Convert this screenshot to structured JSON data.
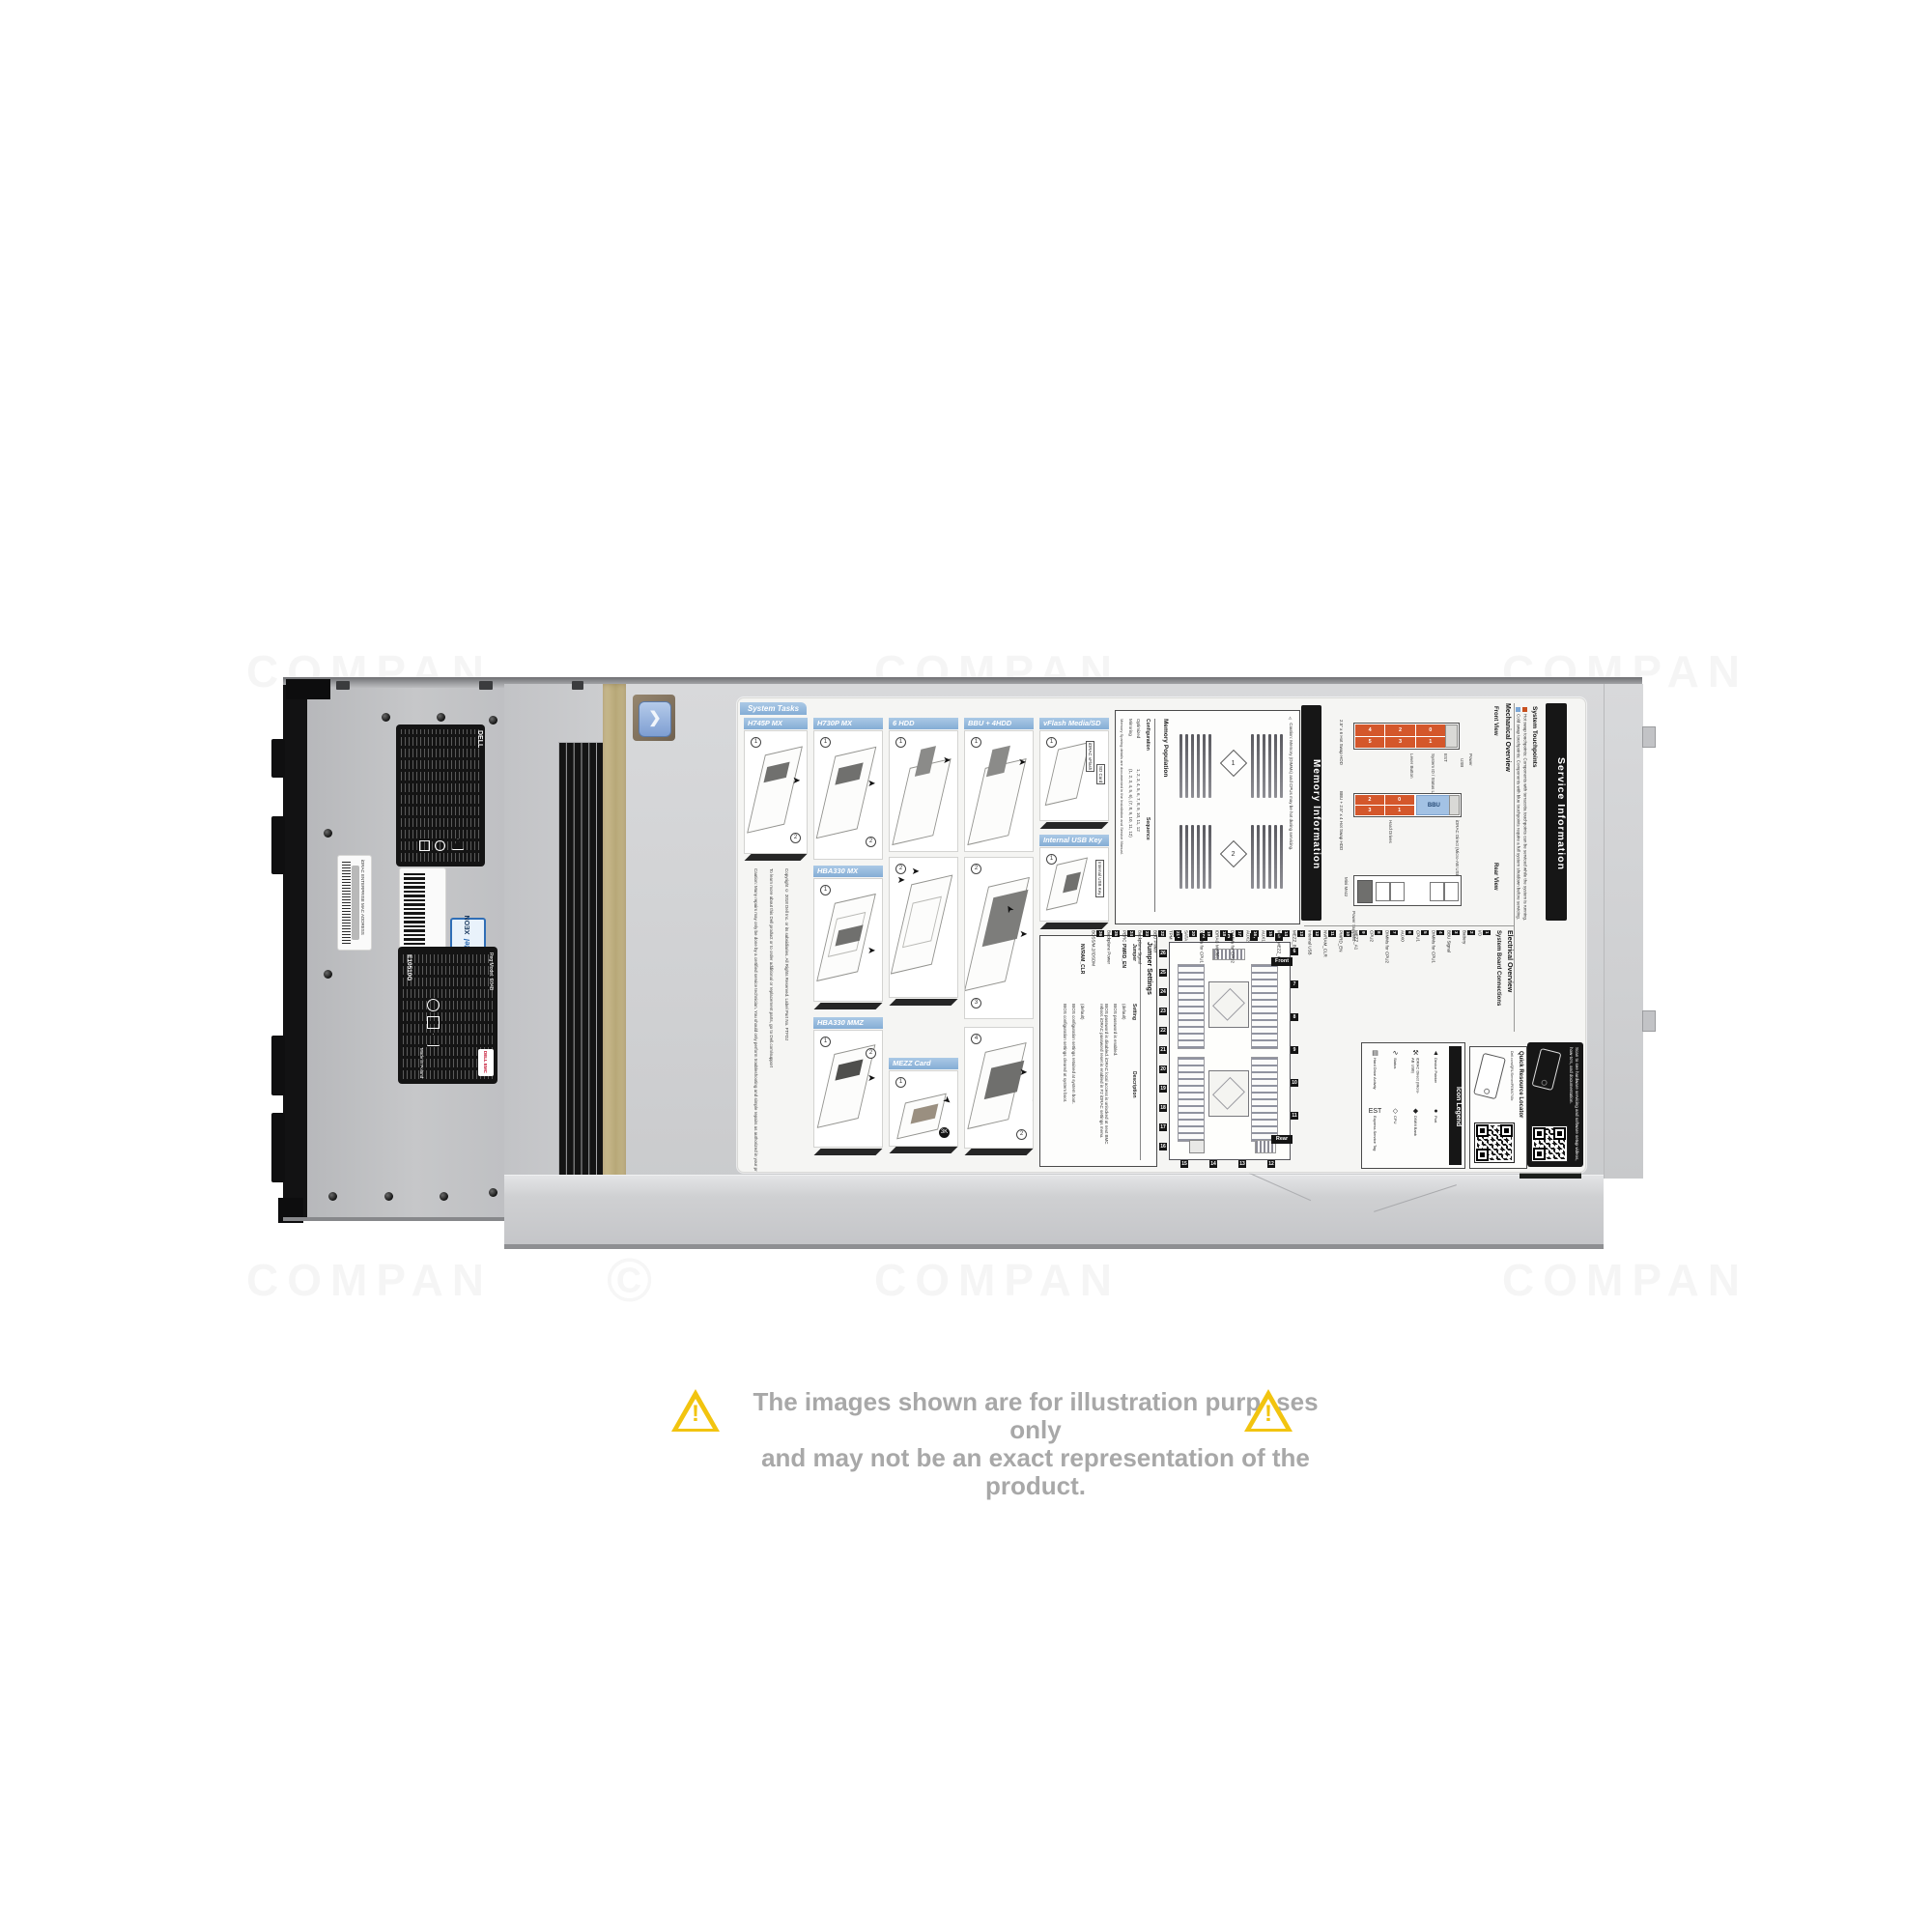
{
  "disclaimer": {
    "line1": "The images shown are for illustration purposes only",
    "line2": "and may not be an exact representation of the product."
  },
  "watermark": {
    "text": "COMPAN",
    "symbol": "©"
  },
  "chassis_labels": {
    "brand": "DELL",
    "service_tag": "253RQX2",
    "idrac_mac": "iDRAC ENTERPRISE MAC ADDRESS",
    "intel_line1": "intel",
    "intel_line2": "XEON",
    "reg_number": "E10510G",
    "reg_model": "Reg Model: E04B",
    "made_in": "Made in Poland",
    "dell_emc": "DELL EMC"
  },
  "service_label": {
    "system_tasks": {
      "tab": "System Tasks",
      "panels": [
        {
          "label": "H745P MX"
        },
        {
          "label": "H730P MX"
        },
        {
          "label": "HBA330 MX"
        },
        {
          "label": "HBA330 MMZ"
        },
        {
          "label": "6 HDD"
        },
        {
          "label": "MEZZ Card"
        },
        {
          "label": "BBU + 4HDD"
        },
        {
          "label": "vFlash Media/SD Card"
        },
        {
          "label": "Internal USB Key"
        }
      ],
      "vflash_callout1": "iDRAC vFlash",
      "vflash_callout2": "SD Card",
      "usb_callout": "Internal USB Key",
      "caution": "Caution: Many repairs may only be done by a certified service technician. You should only perform troubleshooting and simple repairs as authorized in your product documentation, or as directed by the online or telephone service and support team. Damage due to servicing that is not authorized by Dell is not covered by your warranty. Read and follow the safety instructions that came with this product.",
      "support": "To learn more about this Dell product or to order additional or replacement parts, go to Dell.com/support",
      "copyright": "Copyright © 2018 Dell Inc. or its subsidiaries. All Rights Reserved. Label Part No. FTFDJ"
    },
    "memory": {
      "header": "Memory Information",
      "caution": "⚠ Caution: Memory (DIMMs) and CPUs may be hot during servicing.",
      "title": "Memory Population",
      "col_config": "Configuration",
      "col_seq": "Sequence",
      "row1_name": "Optimized",
      "row1_seq": "1, 2, 3, 4, 5, 6, 7, 8, 9, 10, 11, 12",
      "row2_name": "Mirroring",
      "row2_seq": "(1, 2, 3, 4, 5, 6), (7, 8, 9, 10, 11, 12)",
      "note": "Memory Sparing details are documented in the Installation and Service Manual.",
      "cpu1": "1",
      "cpu2": "2"
    },
    "jumpers": {
      "title": "Jumper Settings",
      "col1": "Jumper",
      "col2": "Setting",
      "col3": "Description",
      "row1_name": "PWRD_EN",
      "row1_default": "(default)",
      "row1_desc_default": "BIOS password is enabled.",
      "row1_desc_alt": "BIOS password is disabled. iDRAC local access is unlocked at next BMC reboot. iDRAC password reset is enabled in F2 iDRAC settings menu.",
      "row2_name": "NVRAM_CLR",
      "row2_default": "(default)",
      "row2_desc_default": "BIOS configuration settings retained at system boot.",
      "row2_desc_alt": "BIOS configuration settings cleared at system boot."
    },
    "mechanical": {
      "title": "Mechanical Overview",
      "front": "Front View",
      "rear": "Rear View",
      "bay6_label": "2.5\" x 6 Hot Swap HDD",
      "bay4_label": "BBU + 2.5\" x 4 Hot Swap HDD",
      "bbu": "BBU",
      "drives6": [
        "4",
        "2",
        "0",
        "5",
        "3",
        "1"
      ],
      "drives4": [
        "2",
        "0",
        "3",
        "1"
      ],
      "callouts": {
        "power": "Power",
        "usb": "USB",
        "idrac": "iDRAC Direct (Micro-AB USB)",
        "est": "EST",
        "sid": "System ID / Status Light Bar",
        "lever": "Lever Button",
        "hdd": "Hard Drives",
        "mini_mezz": "Mini Mezz",
        "psu": "Power Supplies"
      }
    },
    "electrical": {
      "title": "Electrical Overview",
      "subtitle": "System Board Connections",
      "front_tag": "Front",
      "rear_tag": "Rear",
      "connections": [
        {
          "n": "1",
          "label": "I/O"
        },
        {
          "n": "2",
          "label": "Battery"
        },
        {
          "n": "3",
          "label": "BBU Signal"
        },
        {
          "n": "4",
          "label": "DIMMs for CPU1"
        },
        {
          "n": "5",
          "label": "CPU1"
        },
        {
          "n": "6",
          "label": "AUX0"
        },
        {
          "n": "7",
          "label": "DIMMs for CPU2"
        },
        {
          "n": "8",
          "label": "CPU2"
        },
        {
          "n": "9",
          "label": "MEZZ_A1"
        },
        {
          "n": "10",
          "label": "PWRD_EN"
        },
        {
          "n": "11",
          "label": "NVRAM_CLR"
        },
        {
          "n": "12",
          "label": "Internal USB"
        },
        {
          "n": "13",
          "label": "MEZZ_B1"
        },
        {
          "n": "14",
          "label": "MINI_MEZZ_C1"
        },
        {
          "n": "15",
          "label": "AUX1"
        },
        {
          "n": "16",
          "label": "AUX2"
        },
        {
          "n": "17",
          "label": "DIMMs for CPU2"
        },
        {
          "n": "18",
          "label": "iDRAC Module"
        },
        {
          "n": "19",
          "label": "DIMMs for CPU1"
        },
        {
          "n": "20",
          "label": "SATA"
        },
        {
          "n": "21",
          "label": "TPM"
        },
        {
          "n": "22",
          "label": "BBU Power"
        },
        {
          "n": "23",
          "label": "Backplane Signal"
        },
        {
          "n": "24",
          "label": "PERC"
        },
        {
          "n": "25",
          "label": "Backplane Power"
        },
        {
          "n": "26",
          "label": "BOSS/M.2/IDSDM"
        }
      ]
    },
    "legend": {
      "title": "Icon Legend",
      "items": [
        {
          "icon": "hard-drive-activity-icon",
          "glyph": "▤",
          "label": "Hard Drive Activity"
        },
        {
          "icon": "status-icon",
          "glyph": "∿",
          "label": "Status"
        },
        {
          "icon": "idrac-direct-icon",
          "glyph": "⚒",
          "label": "iDRAC Direct (Micro-AB USB)"
        },
        {
          "icon": "device-pointer-icon",
          "glyph": "▲",
          "label": "Device Pointer"
        },
        {
          "icon": "est-icon",
          "glyph": "EST",
          "label": "Express Service Tag"
        },
        {
          "icon": "cpu-icon",
          "glyph": "◇",
          "label": "CPU"
        },
        {
          "icon": "dimm-bank-icon",
          "glyph": "◆",
          "label": "DIMM Bank"
        },
        {
          "icon": "port-icon",
          "glyph": "●",
          "label": "Port"
        }
      ]
    },
    "qrl": {
      "title": "Quick Resource Locator",
      "url": "Dell.com/QRL/Server/PEMX740c"
    },
    "service_info": {
      "title": "Service Information",
      "subtitle": "System Touchpoints",
      "hot": "Hot swap touchpoints: Components with terracotta touchpoints can be serviced while the system is running.",
      "cold": "Cold swap touchpoints: Components with blue touchpoints require a full system shutdown before servicing.",
      "scan": "Scan to see hardware servicing and software setup videos, how-to's, and documentation."
    }
  },
  "colors": {
    "hot_swap": "#c8501e",
    "cold_swap": "#7ba7d7",
    "header_blue": "#96bede",
    "drive_orange": "#d4572b",
    "bbu_blue": "#a3c2e4",
    "gold_gasket": "#c4b488",
    "warning_yellow": "#f2c40f",
    "disclaimer_text": "#a8a8a8"
  }
}
